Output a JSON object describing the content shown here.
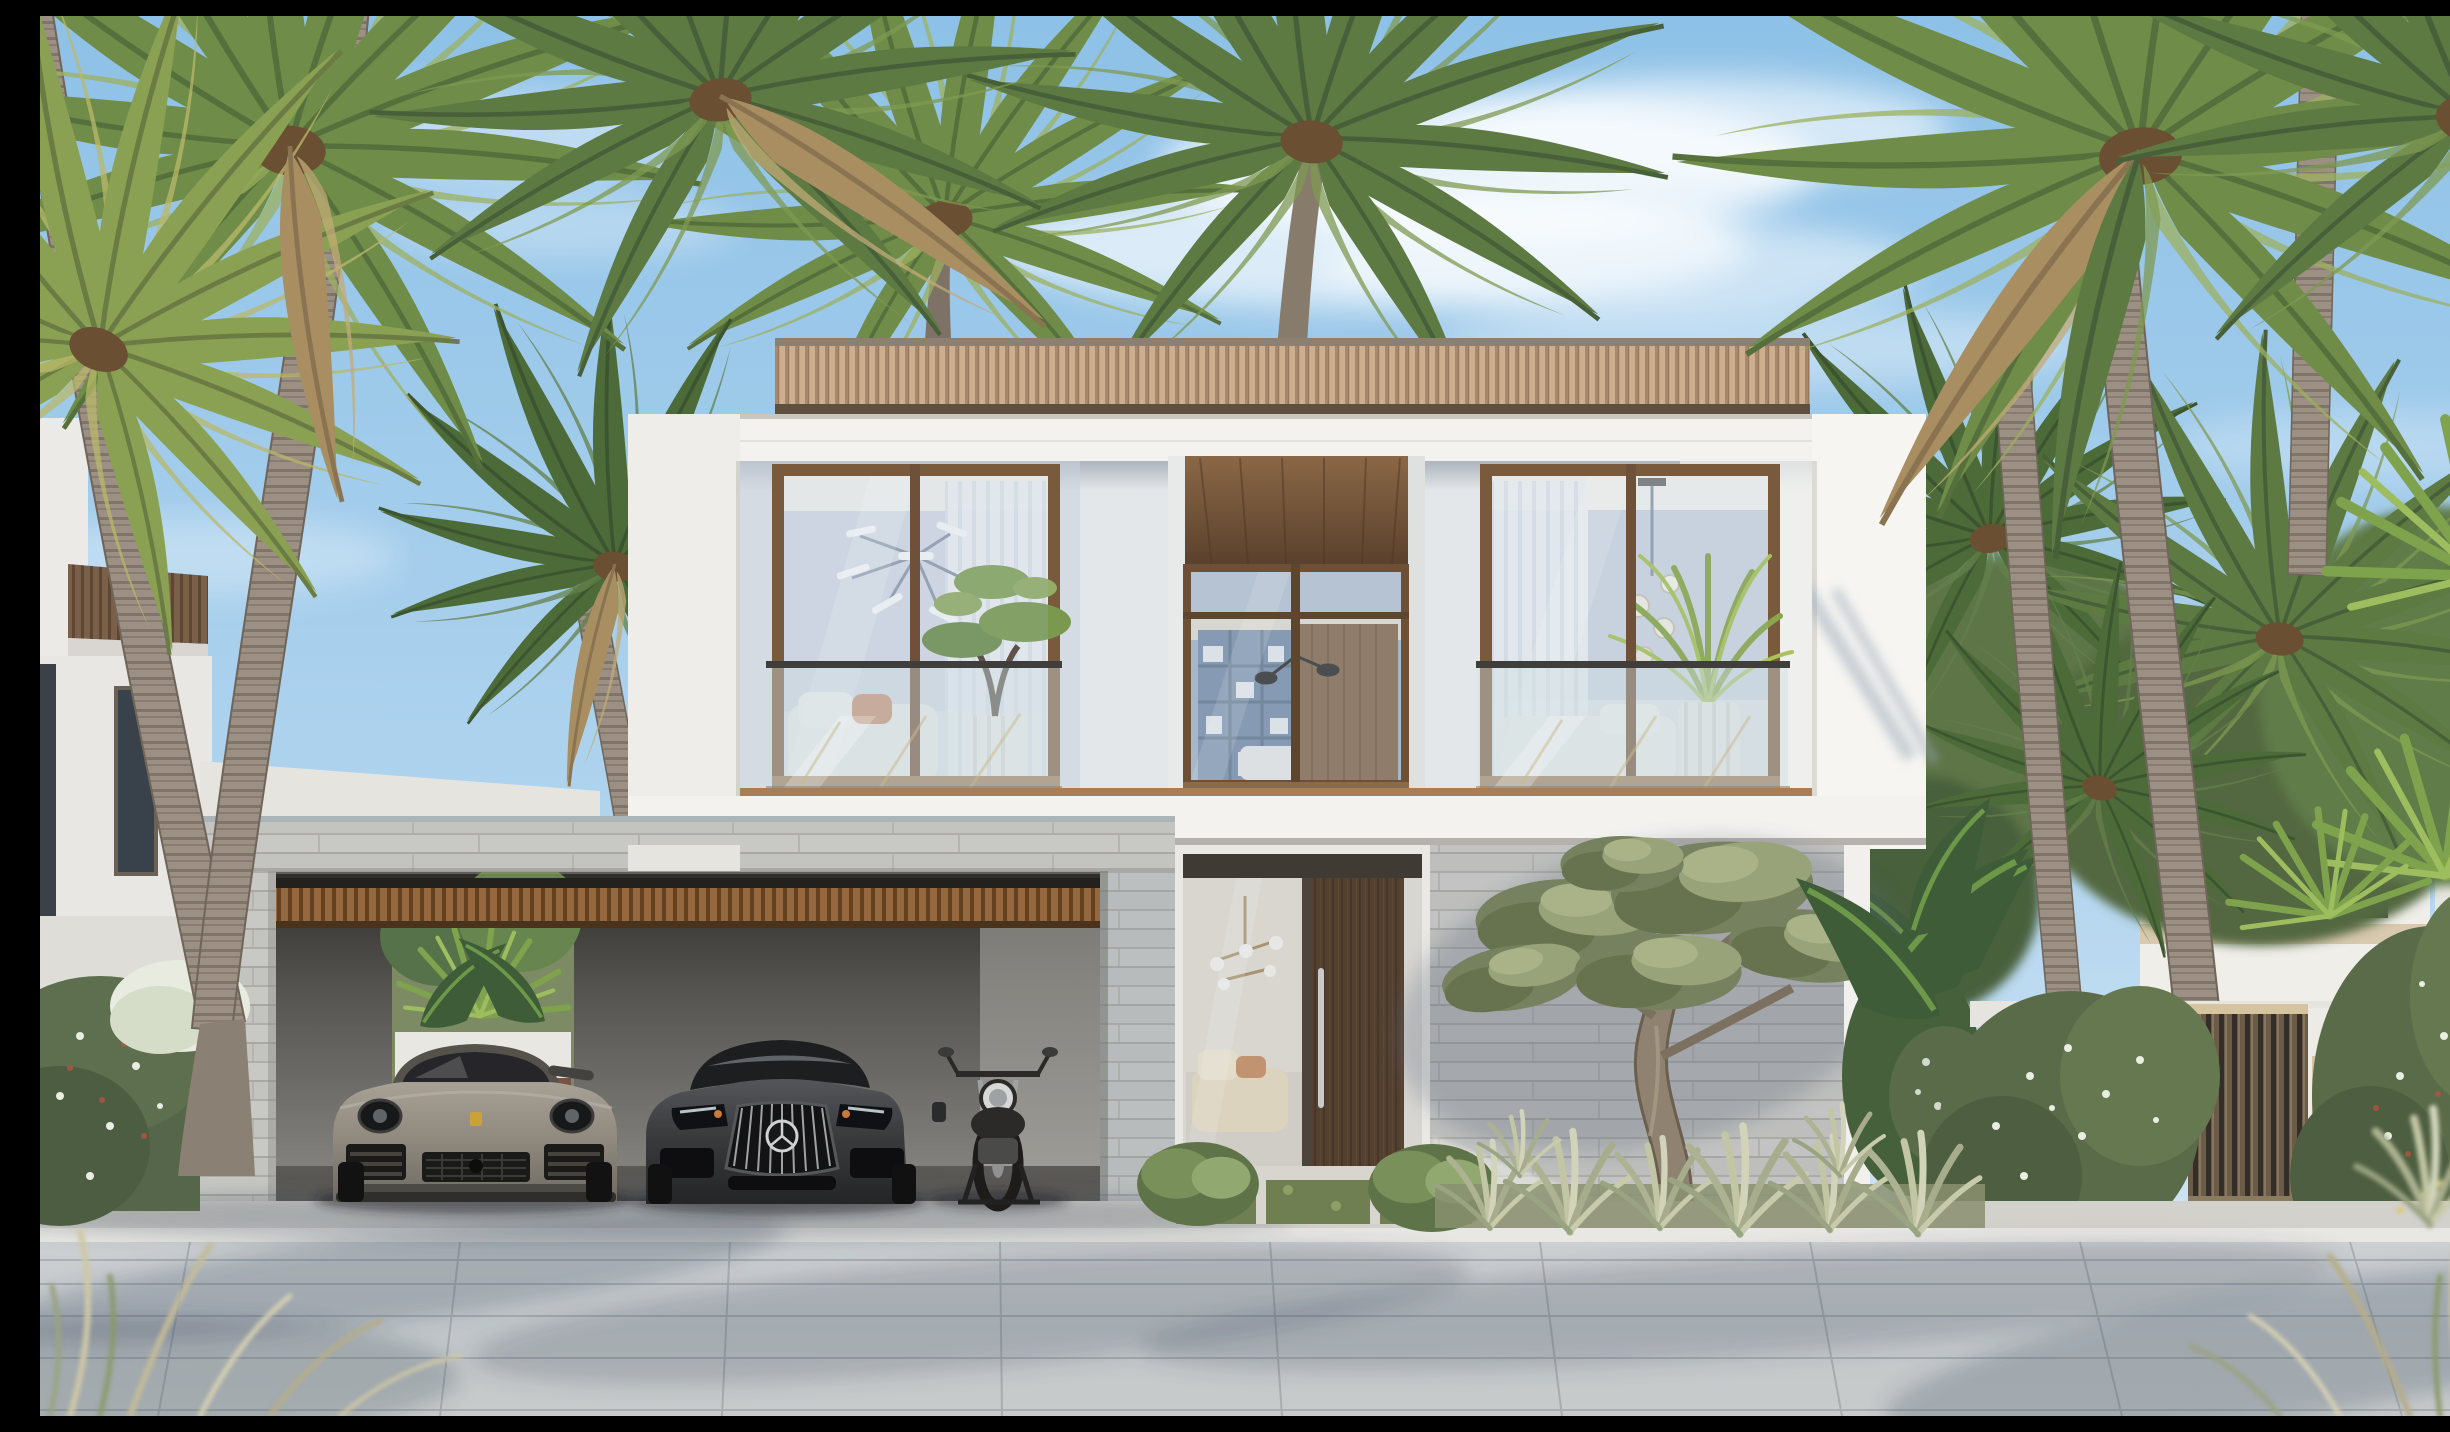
{
  "scene": {
    "title": "Photorealistic exterior rendering of a modern two-storey tropical villa with flat roof, timber-slat fascia, glass balustrades, stone-clad ground floor, carport with a grey Porsche 911, a dark Mercedes-AMG GT and a cafe-racer motorcycle, framed by tall coconut palms under a sunny blue sky",
    "type": "architectural visualization photo",
    "time_of_day": "midday, clear sky with thin cirrus clouds",
    "camera": "frontal elevation view from the street"
  },
  "palette": {
    "sky_top": "#8ec1e7",
    "sky_mid": "#aed3ee",
    "sky_low": "#dcebf6",
    "cloud_white": "#ffffff",
    "palm_green_dark": "#4c6b38",
    "palm_green": "#6f8c48",
    "palm_green_light": "#9cb05e",
    "palm_dry": "#a98e62",
    "trunk_grey": "#9b9083",
    "trunk_ring": "#7e7467",
    "fascia_wood": "#c2a284",
    "fascia_wood_dark": "#a7886a",
    "fascia_shadow": "#5e4f3f",
    "wall_white": "#f3f2ef",
    "wall_shade": "#e2e4e8",
    "wall_blue_shade": "#c9d2dd",
    "window_frame_bronze": "#7a5a3c",
    "soffit_walnut": "#7b5a3e",
    "glass_tint": "#c3d2da",
    "interior_blue": "#9fb3c6",
    "interior_warm": "#ece5d9",
    "balustrade_rail": "#3f3e3b",
    "stone_light": "#c8c8c4",
    "stone_line": "#a9a8a3",
    "stone_blue_tint": "#b4bcc2",
    "carport_ceiling_wood": "#96683f",
    "carport_shadow": "#3c3a37",
    "door_walnut": "#53402f",
    "door_handle_steel": "#c9cbcb",
    "porsche_grey": "#8e887d",
    "mercedes_grey": "#3a3b3d",
    "chrome": "#c8c9ca",
    "drl_orange": "#c97a3a",
    "moto_black": "#2b2a28",
    "hedge_green": "#5a6b4a",
    "bloom_white": "#e9eee2",
    "gate_slat_bronze": "#6b5c49",
    "gate_rail_tan": "#d6c3a0",
    "gate_door_white": "#edebe6",
    "olive_leaf": "#7e8a66",
    "olive_leaf_light": "#a2ad82",
    "olive_trunk": "#8f8271",
    "grass_sage": "#adb392",
    "grass_cream": "#d2d4ba",
    "paver_light": "#c7cbce",
    "paver_curb": "#e8e7e3",
    "paver_shadow_blue": "#8f97a1"
  },
  "objects": {
    "main_house": {
      "storeys": 2,
      "roof": "flat roof with vertical timber-slat fascia band",
      "upper_floor": [
        "left bedroom window with bronze frame, sputnik chandelier, cloud-pruned bonsai in white pot, white sofa",
        "center recessed balcony with walnut soffit, glass wall, bookshelf and walnut slat wall inside",
        "right bedroom window with sheer curtains, glass pendant lights, areca palm in white pot"
      ],
      "balustrades": "frameless glass with slim dark top rail",
      "ground_floor": [
        "stone-clad carport portal with timber slat ceiling",
        "entry with glass sidelight and tall walnut pivot door with steel handle",
        "stone-clad feature wall with sculptural olive tree"
      ]
    },
    "vehicles": {
      "car_left": {
        "model": "Porsche 911 coupe",
        "color": "warm agate grey",
        "crest": "gold bonnet crest"
      },
      "car_right": {
        "model": "Mercedes-AMG GT",
        "color": "dark graphite grey",
        "grille": "Panamericana vertical chrome bars with central star"
      },
      "motorcycle": {
        "type": "cafe racer on paddock stand",
        "color": "black with chrome round headlamp"
      }
    },
    "vegetation": {
      "coconut_palms_foreground": 7,
      "coconut_palms_background": "dense cluster left and right",
      "olive_tree": "gnarled trunk, grey-green canopy pads",
      "hedges": "white-flowering jasmine hedge at right boundary, flowering hedge far left",
      "grasses": "sage ornamental grass bed below olive tree, dry grass tufts in bottom corners",
      "garden_glimpse": "banana and fan palm leaves behind carport opening and beside house"
    },
    "boundary": {
      "gate": "vertical bronze-slat driveway gate",
      "pedestrian_door": "white door with tan handle strip",
      "neighbor_left": "white villa with dark bronze slat fascia and tall dark window",
      "building_right_background": "white building with beige band behind palms"
    },
    "ground": "large-format light grey pavers with soft palm shadows, pale curb band at carport apron, green groundcover strip at entry"
  }
}
